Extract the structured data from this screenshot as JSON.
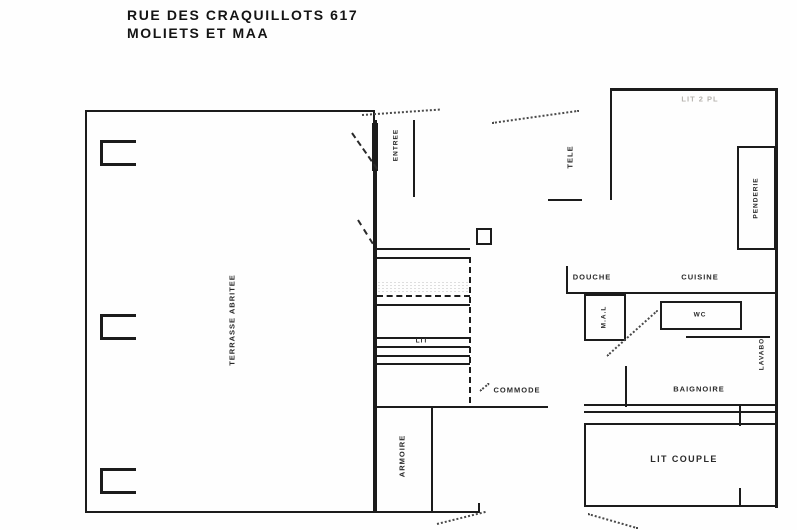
{
  "title": {
    "line1": "RUE DES CRAQUILLOTS 617",
    "line2": "MOLIETS ET MAA"
  },
  "labels": {
    "terrace": "TERRASSE ABRITEE",
    "entry": "ENTREE",
    "bed_mezzanine": "LIT",
    "dresser": "COMMODE",
    "wardrobe": "ARMOIRE",
    "tv": "TELE",
    "bedroom2_faint": "LIT 2 PL",
    "closet": "PENDERIE",
    "shower": "DOUCHE",
    "kitchen": "CUISINE",
    "washing_machine": "M.A.L",
    "wc": "WC",
    "sink": "LAVABO",
    "bathtub": "BAIGNOIRE",
    "double_bed": "LIT COUPLE"
  },
  "colors": {
    "wall": "#1c1c1c",
    "label": "#2a2a2a",
    "faint_label": "#b6b3ae",
    "background": "#fefefe"
  }
}
